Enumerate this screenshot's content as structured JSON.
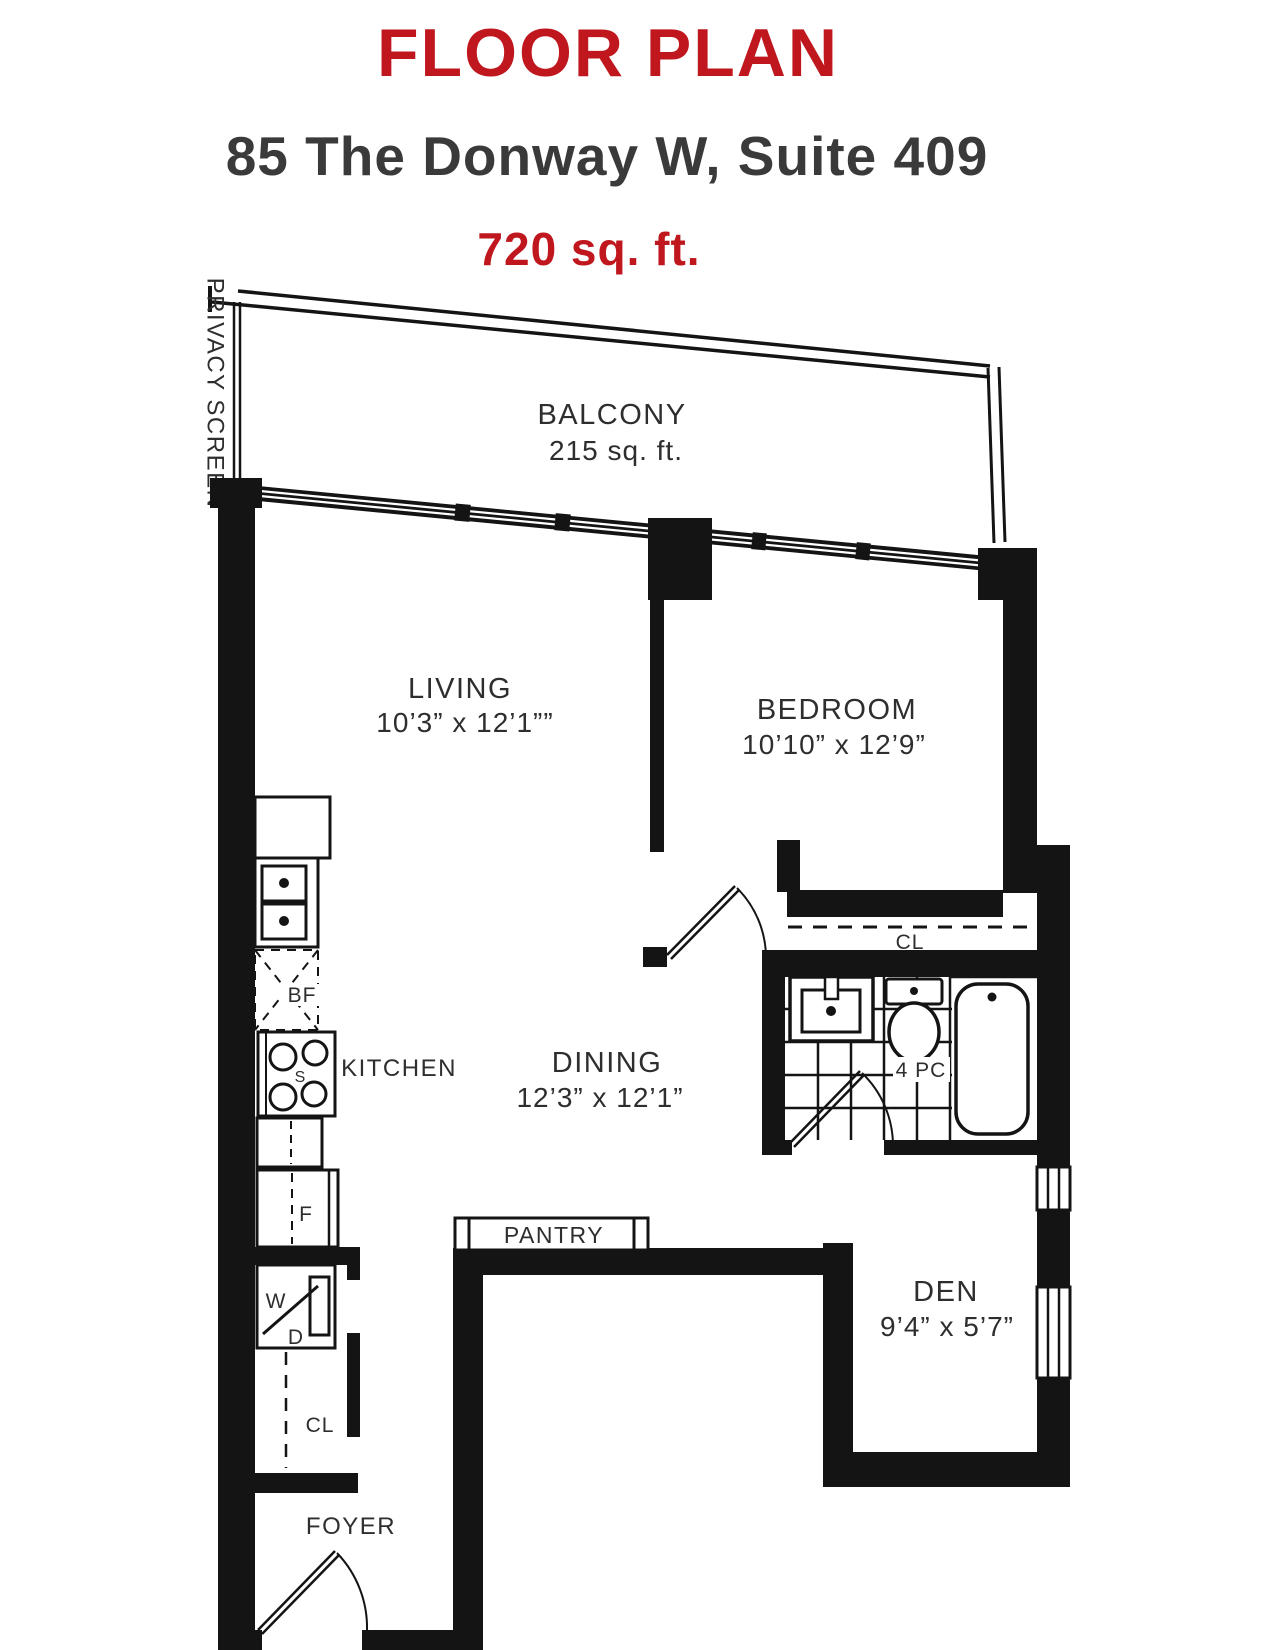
{
  "header": {
    "title": "FLOOR PLAN",
    "address": "85 The Donway W, Suite 409",
    "area": "720 sq. ft."
  },
  "colors": {
    "accent": "#BF171D",
    "heading_text": "#3A3A3B",
    "line": "#141414"
  },
  "plan": {
    "privacy_screen": "PRIVACY SCREEN",
    "balcony": {
      "name": "BALCONY",
      "size": "215 sq. ft."
    },
    "living": {
      "name": "LIVING",
      "dims": "10’3” x 12’1””"
    },
    "bedroom": {
      "name": "BEDROOM",
      "dims": "10’10” x 12’9”"
    },
    "dining": {
      "name": "DINING",
      "dims": "12’3” x 12’1”"
    },
    "den": {
      "name": "DEN",
      "dims": "9’4” x 5’7”"
    },
    "kitchen": {
      "name": "KITCHEN"
    },
    "bathroom": {
      "name": "4 PC"
    },
    "bedroom_closet": "CL",
    "foyer_closet": "CL",
    "pantry": "PANTRY",
    "foyer": "FOYER",
    "appliances": {
      "bar_fridge": "BF",
      "stove": "S",
      "fridge": "F",
      "washer": "W",
      "dryer": "D"
    }
  }
}
